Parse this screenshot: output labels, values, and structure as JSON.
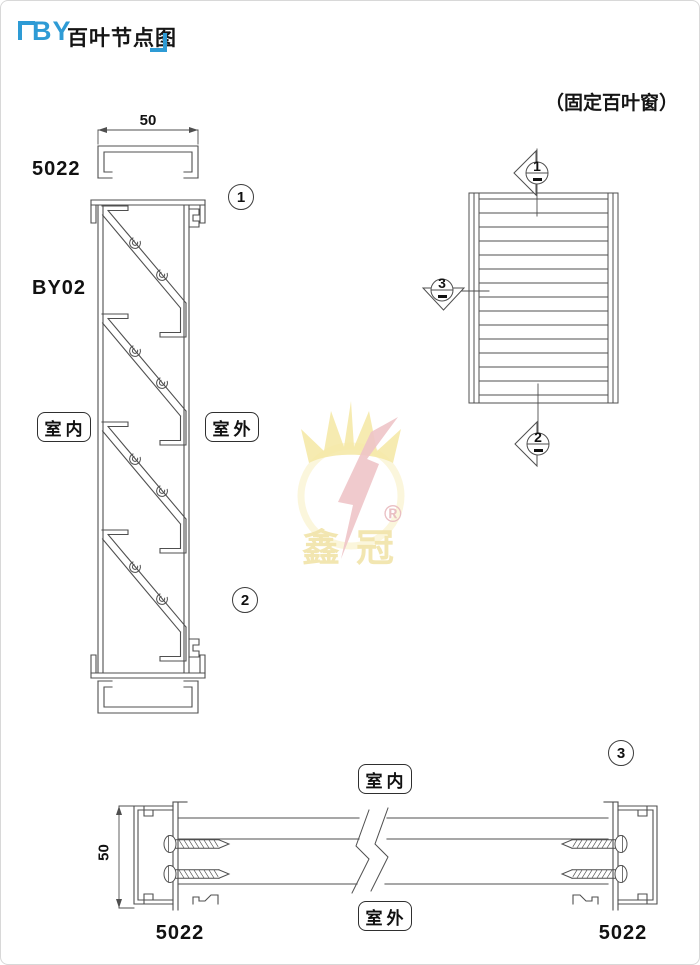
{
  "header": {
    "title_prefix": "BY",
    "title_text": "百叶节点图",
    "subtitle": "（固定百叶窗）"
  },
  "section_view": {
    "width_dim": "50",
    "frame_code": "5022",
    "profile_code": "BY02",
    "indoor_label": "室内",
    "outdoor_label": "室外",
    "detail_top": "1",
    "detail_bottom": "2"
  },
  "elevation_view": {
    "marker_top": "1",
    "marker_left": "3",
    "marker_bottom": "2"
  },
  "plan_view": {
    "height_dim": "50",
    "indoor_label": "室内",
    "outdoor_label": "室外",
    "frame_code_left": "5022",
    "frame_code_right": "5022",
    "detail": "3"
  },
  "watermark": {
    "brand": "鑫冠",
    "registered_mark": "®"
  },
  "colors": {
    "accent": "#2e9bd5",
    "line": "#4f4f4f"
  }
}
